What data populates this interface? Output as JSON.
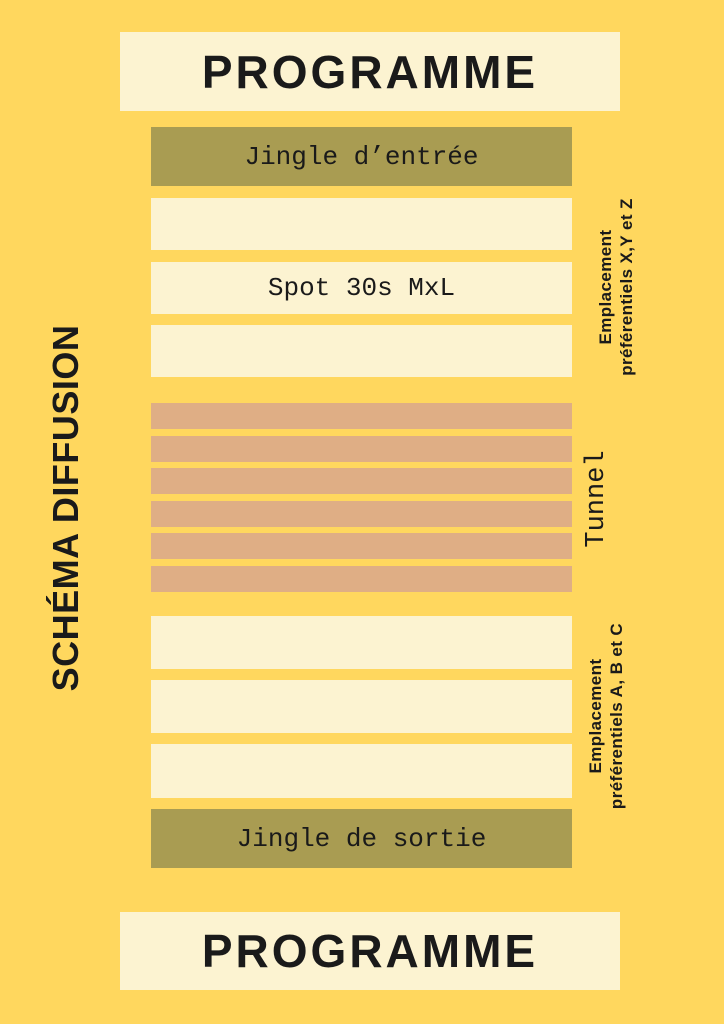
{
  "colors": {
    "background": "#FFD75E",
    "cream": "#FCF3D1",
    "olive": "#A99C52",
    "salmon": "#DFAE85",
    "text": "#1A1A1A"
  },
  "header": {
    "title": "PROGRAMME"
  },
  "footer": {
    "title": "PROGRAMME"
  },
  "sidebar": {
    "label": "SCHÉMA DIFFUSION"
  },
  "timeline": {
    "jingle_in": "Jingle d’entrée",
    "spot": "Spot 30s MxL",
    "jingle_out": "Jingle de sortie",
    "empty_slot_count_top": 2,
    "empty_slot_count_bottom": 3,
    "tunnel_bar_count": 6
  },
  "annotations": {
    "top_right": {
      "line1": "Emplacement",
      "line2": "préférentiels X,Y et Z"
    },
    "tunnel": "Tunnel",
    "bottom_right": {
      "line1": "Emplacement",
      "line2": "préférentiels A, B et C"
    }
  }
}
